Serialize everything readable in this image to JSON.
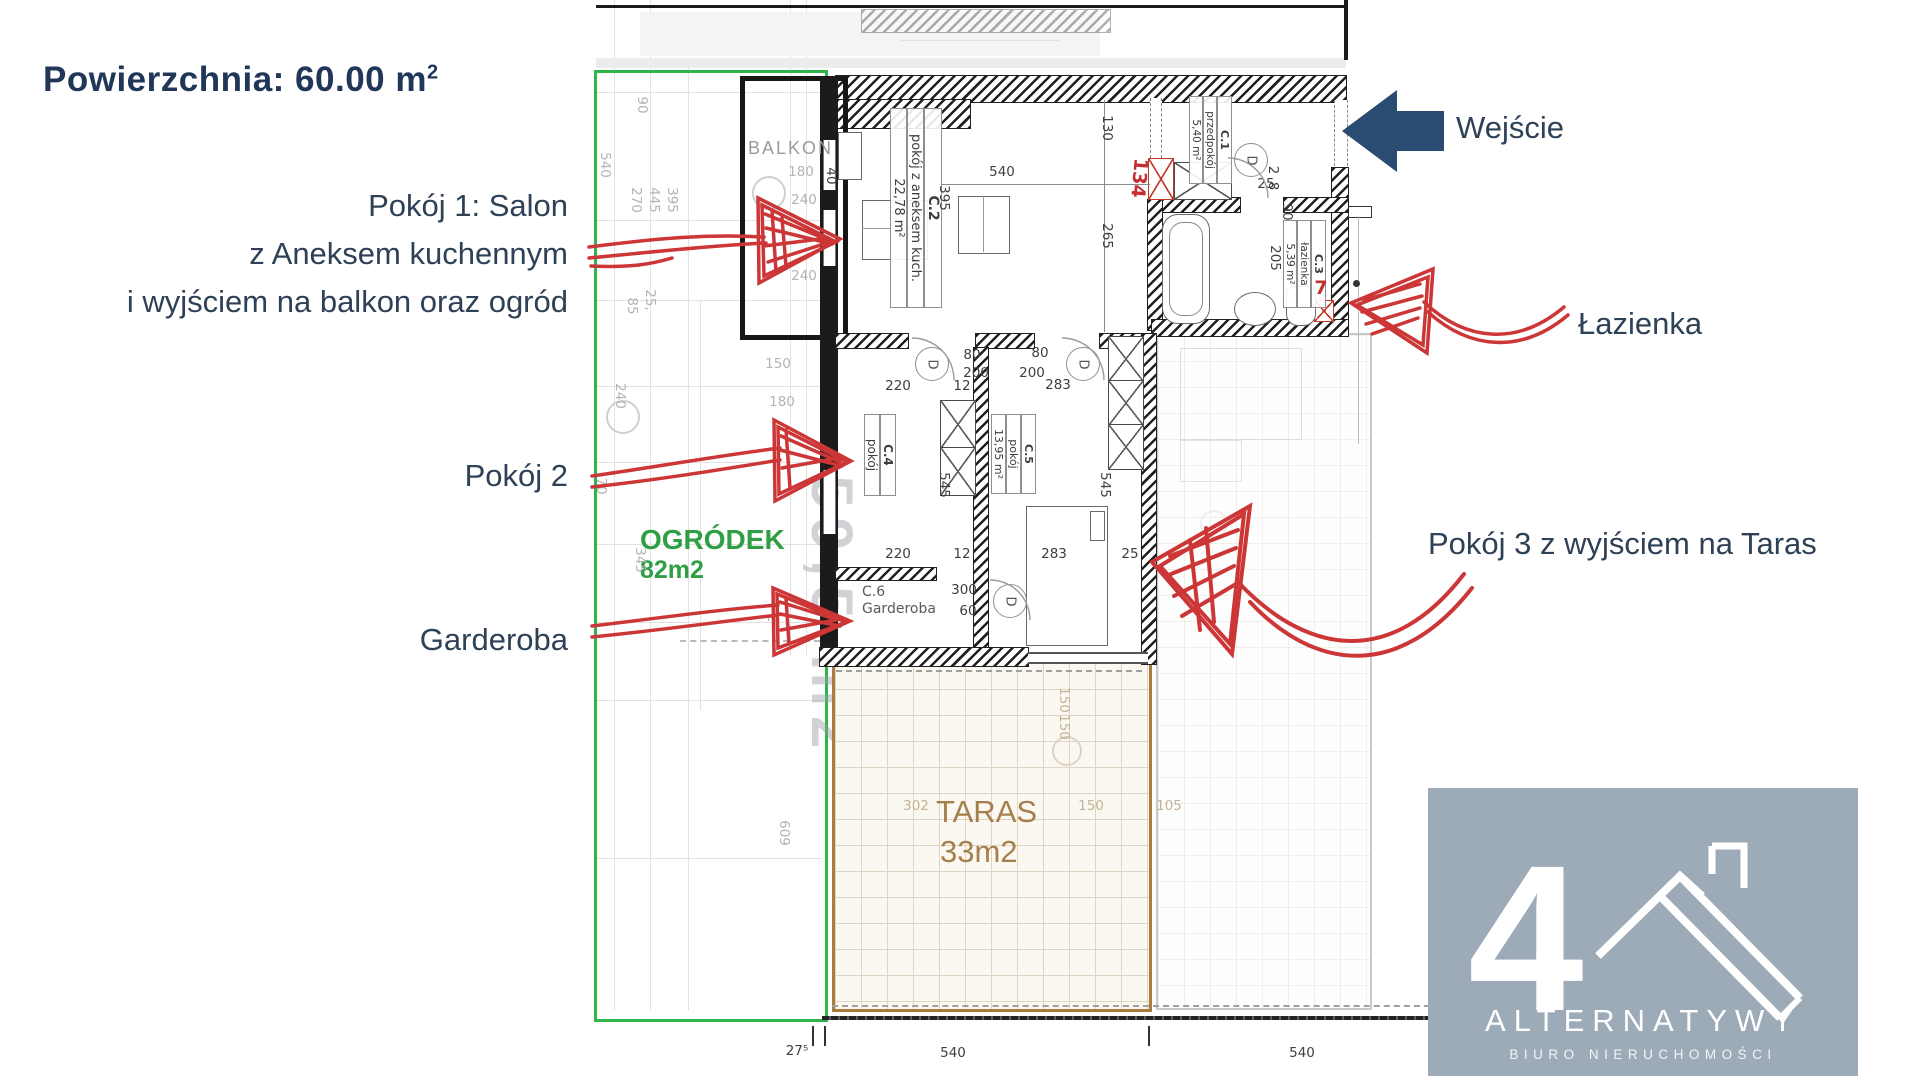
{
  "header": {
    "area_text": "Powierzchnia: 60.00 m",
    "area_exponent": "2"
  },
  "labels": {
    "room1_line1": "Pokój 1: Salon",
    "room1_line2": "z Aneksem kuchennym",
    "room1_line3": "i wyjściem na balkon oraz ogród",
    "room2": "Pokój 2",
    "garderoba": "Garderoba",
    "entrance": "Wejście",
    "bathroom": "Łazienka",
    "room3": "Pokój 3 z wyjściem na Taras"
  },
  "plan": {
    "balcony": "BALKON",
    "garden_name": "OGRÓDEK",
    "garden_area": "82m2",
    "terrace_name": "TARAS",
    "terrace_area": "33m2",
    "watermark": "- 59,5 m2",
    "door_letter": "D",
    "rooms": {
      "c1": {
        "id": "C.1",
        "name": "przedpokój",
        "area": "5,40 m²"
      },
      "c2": {
        "id": "C.2",
        "name": "pokój z aneksem kuch.",
        "area": "22,78 m²"
      },
      "c3": {
        "id": "C.3",
        "name": "łazienka",
        "area": "5,39 m²"
      },
      "c4": {
        "id": "C.4",
        "name": "pokój"
      },
      "c5": {
        "id": "C.5",
        "name": "pokój",
        "area": "13,95 m²"
      },
      "c6": {
        "id": "C.6",
        "name": "Garderoba"
      }
    },
    "doors": [
      {
        "x": 932,
        "y": 364
      },
      {
        "x": 1083,
        "y": 364
      },
      {
        "x": 1251,
        "y": 160
      },
      {
        "x": 1010,
        "y": 601
      }
    ],
    "dims": [
      {
        "t": "90",
        "x": 642,
        "y": 105,
        "v": 1,
        "c": "f"
      },
      {
        "t": "540",
        "x": 605,
        "y": 165,
        "v": 1,
        "c": "f"
      },
      {
        "t": "270",
        "x": 636,
        "y": 200,
        "v": 1,
        "c": "f"
      },
      {
        "t": "445",
        "x": 654,
        "y": 200,
        "v": 1,
        "c": "f"
      },
      {
        "t": "395",
        "x": 672,
        "y": 200,
        "v": 1,
        "c": "f"
      },
      {
        "t": "25,",
        "x": 650,
        "y": 300,
        "v": 1,
        "c": "f"
      },
      {
        "t": "85",
        "x": 632,
        "y": 306,
        "v": 1,
        "c": "f"
      },
      {
        "t": "240",
        "x": 620,
        "y": 396,
        "v": 1,
        "c": "f"
      },
      {
        "t": "150",
        "x": 778,
        "y": 364,
        "c": "f"
      },
      {
        "t": "180",
        "x": 782,
        "y": 402,
        "c": "f"
      },
      {
        "t": "345",
        "x": 640,
        "y": 560,
        "v": 1,
        "c": "f"
      },
      {
        "t": "70",
        "x": 601,
        "y": 486,
        "v": 1,
        "c": "f"
      },
      {
        "t": "2",
        "x": 772,
        "y": 618,
        "v": 1,
        "c": "f"
      },
      {
        "t": "609",
        "x": 784,
        "y": 833,
        "v": 1,
        "c": "f"
      },
      {
        "t": "180",
        "x": 801,
        "y": 172,
        "c": "f"
      },
      {
        "t": "240",
        "x": 804,
        "y": 200,
        "c": "f"
      },
      {
        "t": "240",
        "x": 804,
        "y": 276,
        "c": "f"
      },
      {
        "t": "40",
        "x": 831,
        "y": 176,
        "v": 1,
        "c": "d"
      },
      {
        "t": "540",
        "x": 1002,
        "y": 172,
        "c": "d"
      },
      {
        "t": "130",
        "x": 1107,
        "y": 128,
        "v": 1,
        "c": "d"
      },
      {
        "t": "265",
        "x": 1107,
        "y": 236,
        "v": 1,
        "c": "d"
      },
      {
        "t": "395",
        "x": 944,
        "y": 198,
        "v": 1,
        "c": "d"
      },
      {
        "t": "80",
        "x": 972,
        "y": 355,
        "c": "d"
      },
      {
        "t": "80",
        "x": 1040,
        "y": 353,
        "c": "d"
      },
      {
        "t": "200",
        "x": 976,
        "y": 373,
        "c": "d"
      },
      {
        "t": "200",
        "x": 1032,
        "y": 373,
        "c": "d"
      },
      {
        "t": "220",
        "x": 898,
        "y": 386,
        "c": "d"
      },
      {
        "t": "12",
        "x": 962,
        "y": 386,
        "c": "d"
      },
      {
        "t": "283",
        "x": 1058,
        "y": 385,
        "c": "d"
      },
      {
        "t": "545",
        "x": 944,
        "y": 485,
        "v": 1,
        "c": "d"
      },
      {
        "t": "545",
        "x": 1105,
        "y": 485,
        "v": 1,
        "c": "d"
      },
      {
        "t": "220",
        "x": 898,
        "y": 554,
        "c": "d"
      },
      {
        "t": "12",
        "x": 962,
        "y": 554,
        "c": "d"
      },
      {
        "t": "283",
        "x": 1054,
        "y": 554,
        "c": "d"
      },
      {
        "t": "25",
        "x": 1130,
        "y": 554,
        "c": "d"
      },
      {
        "t": "300",
        "x": 964,
        "y": 590,
        "c": "d"
      },
      {
        "t": "60",
        "x": 968,
        "y": 611,
        "c": "d"
      },
      {
        "t": "205",
        "x": 1275,
        "y": 258,
        "v": 1,
        "c": "d"
      },
      {
        "t": "90",
        "x": 1287,
        "y": 212,
        "v": 1,
        "c": "d"
      },
      {
        "t": "25",
        "x": 1266,
        "y": 184,
        "c": "d"
      },
      {
        "t": "2",
        "x": 1273,
        "y": 170,
        "v": 1,
        "c": "d"
      },
      {
        "t": "8",
        "x": 1273,
        "y": 186,
        "v": 1,
        "c": "d"
      },
      {
        "t": "302",
        "x": 916,
        "y": 806,
        "c": "t"
      },
      {
        "t": "150",
        "x": 1091,
        "y": 806,
        "c": "t"
      },
      {
        "t": "105",
        "x": 1169,
        "y": 806,
        "c": "t"
      },
      {
        "t": "150",
        "x": 1064,
        "y": 700,
        "v": 1,
        "c": "t"
      },
      {
        "t": "150",
        "x": 1064,
        "y": 727,
        "v": 1,
        "c": "t"
      },
      {
        "t": "27⁵",
        "x": 797,
        "y": 1051,
        "c": "d"
      },
      {
        "t": "540",
        "x": 953,
        "y": 1053,
        "c": "d"
      },
      {
        "t": "540",
        "x": 1302,
        "y": 1053,
        "c": "d"
      },
      {
        "t": "134",
        "x": 1139,
        "y": 178,
        "v": 1,
        "c": "r"
      },
      {
        "t": "7",
        "x": 1321,
        "y": 288,
        "c": "r"
      }
    ]
  },
  "logo": {
    "numeral": "4",
    "brand": "ALTERNATYWY",
    "subtitle": "BIURO NIERUCHOMOŚCI"
  }
}
